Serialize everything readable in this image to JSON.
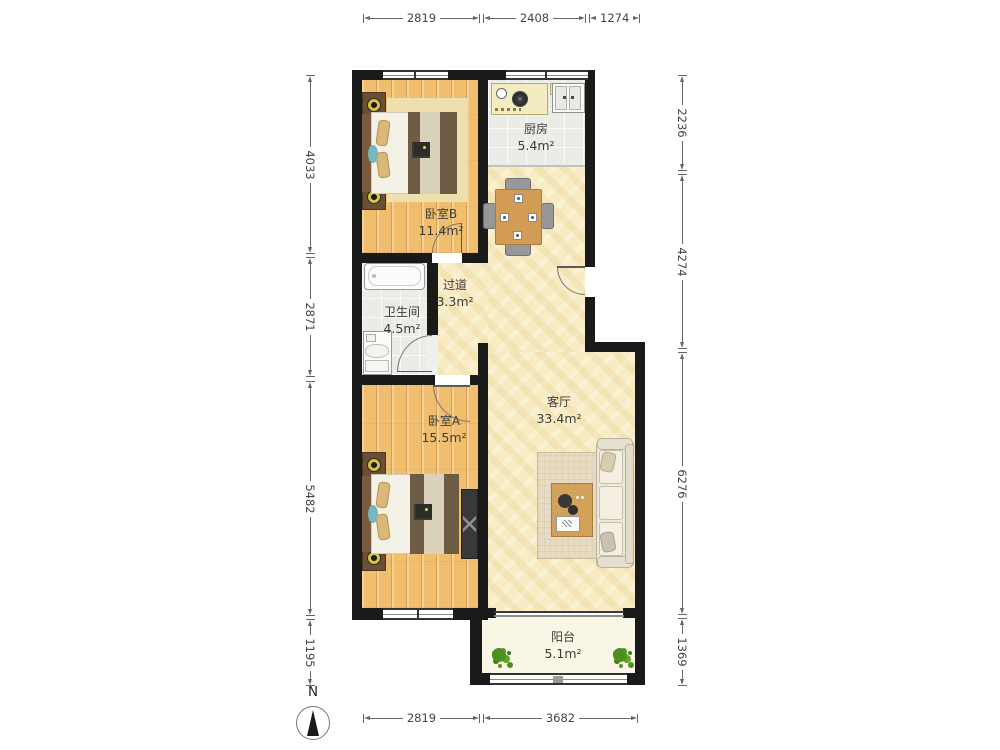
{
  "rooms": [
    {
      "id": "bedroomB",
      "name": "卧室B",
      "area": "11.4m²"
    },
    {
      "id": "kitchen",
      "name": "厨房",
      "area": "5.4m²"
    },
    {
      "id": "hallway",
      "name": "过道",
      "area": "3.3m²"
    },
    {
      "id": "bathroom",
      "name": "卫生间",
      "area": "4.5m²"
    },
    {
      "id": "bedroomA",
      "name": "卧室A",
      "area": "15.5m²"
    },
    {
      "id": "living",
      "name": "客厅",
      "area": "33.4m²"
    },
    {
      "id": "balcony",
      "name": "阳台",
      "area": "5.1m²"
    }
  ],
  "dimensions": {
    "top": [
      "2819",
      "2408",
      "1274"
    ],
    "bottom": [
      "2819",
      "3682"
    ],
    "left": [
      "4033",
      "2871",
      "5482",
      "1195"
    ],
    "right": [
      "2236",
      "4274",
      "6276",
      "1369"
    ]
  },
  "compass": {
    "north_label": "N"
  },
  "colors": {
    "wall": "#1A1A1A",
    "bedroom_floor": "#F1BE6E",
    "living_floor": "#F8ECC4",
    "tile_floor": "#EBEBE7",
    "balcony_floor": "#FAF6E6",
    "plant": "#4F8F1F",
    "label_text": "#3C3C3C",
    "dimension_text": "#444444"
  }
}
